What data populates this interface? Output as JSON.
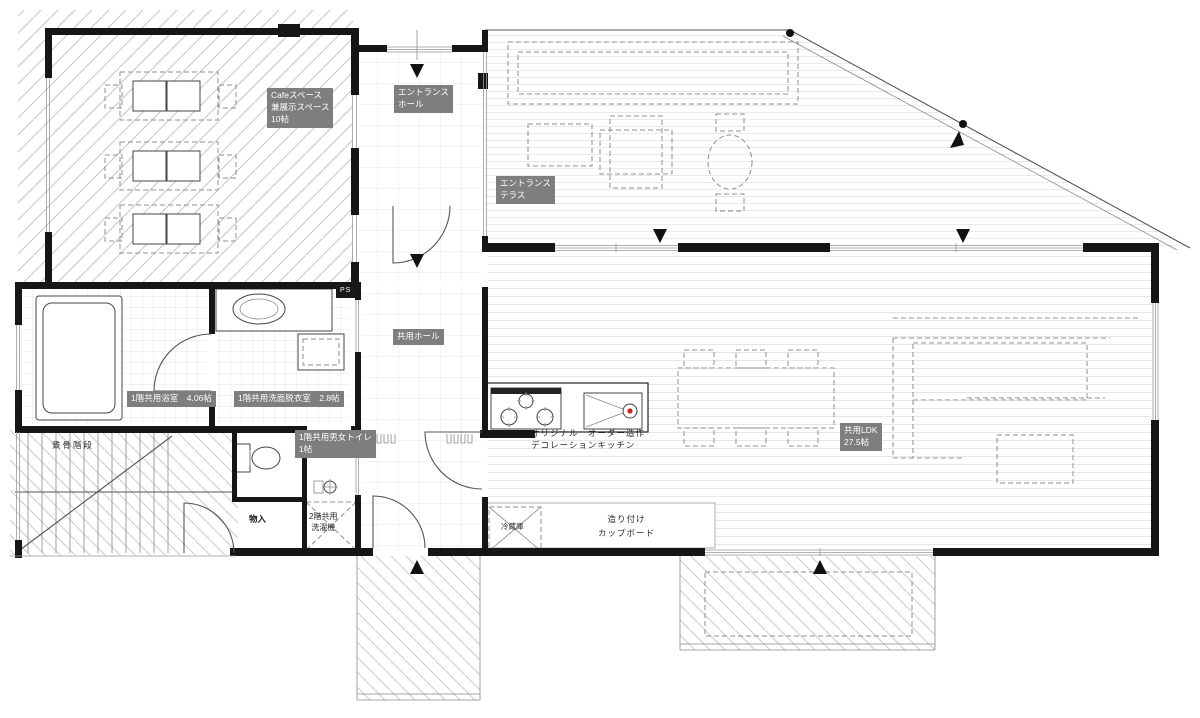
{
  "labels": {
    "cafe": "Cafeスペース\n兼展示スペース\n10帖",
    "entrance_hall": "エントランス\nホール",
    "entrance_terrace": "エントランス\nテラス",
    "common_hall": "共用ホール",
    "ps": "PS",
    "bathroom": "1階共用浴室　4.06帖",
    "washroom": "1階共用洗面脱衣室　2.8帖",
    "toilet": "1階共用男女トイレ\n1帖",
    "stairs": "鉄骨階段",
    "storage": "物入",
    "washer": "2階共用\n洗濯機",
    "kitchen": "オリジナル　オーダー造作\nデコレーションキッチン",
    "ldk": "共用LDK\n27.5帖",
    "cupboard": "造り付け\nカップボード",
    "refrigerator": "冷蔵庫"
  },
  "icons": {
    "entry_arrow_down": "▼",
    "entry_arrow_up": "▲"
  },
  "colors": {
    "wall": "#161616",
    "label_bg": "#7e7e7e",
    "label_text": "#ffffff",
    "hatch": "#c8c8c8",
    "sink_accent": "#cc2222"
  }
}
